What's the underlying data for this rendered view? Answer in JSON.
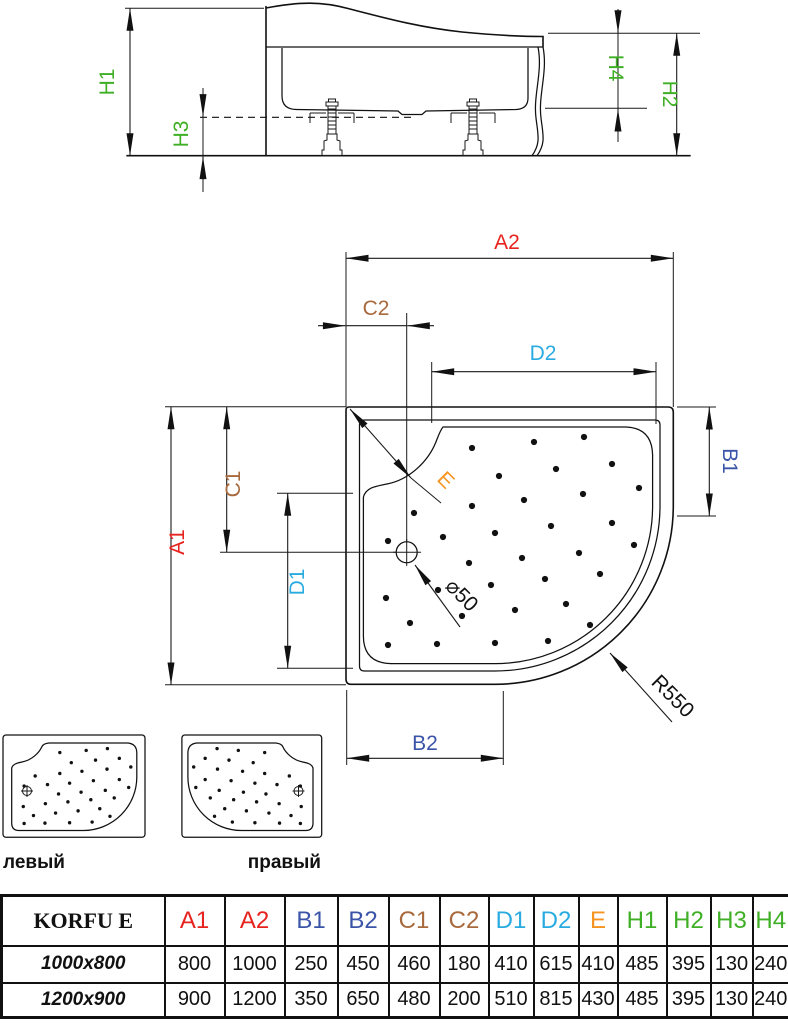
{
  "colors": {
    "red": "#e6231e",
    "blue": "#3a54a8",
    "brown": "#a86a3c",
    "cyan": "#29abe2",
    "orange": "#f79421",
    "green": "#3faf25",
    "line": "#111111"
  },
  "side_view": {
    "labels": {
      "h1": "H1",
      "h2": "H2",
      "h3": "H3",
      "h4": "H4"
    }
  },
  "top_view": {
    "labels": {
      "a1": "A1",
      "a2": "A2",
      "b1": "B1",
      "b2": "B2",
      "c1": "C1",
      "c2": "C2",
      "d1": "D1",
      "d2": "D2",
      "e": "E"
    },
    "drain_label": "⌀50",
    "radius_label": "R550",
    "dots": [
      [
        472,
        448
      ],
      [
        534,
        442
      ],
      [
        584,
        437
      ],
      [
        499,
        476
      ],
      [
        556,
        469
      ],
      [
        612,
        464
      ],
      [
        414,
        513
      ],
      [
        472,
        506
      ],
      [
        524,
        500
      ],
      [
        583,
        494
      ],
      [
        639,
        488
      ],
      [
        388,
        541
      ],
      [
        443,
        537
      ],
      [
        495,
        533
      ],
      [
        551,
        526
      ],
      [
        612,
        523
      ],
      [
        469,
        563
      ],
      [
        522,
        558
      ],
      [
        579,
        553
      ],
      [
        634,
        545
      ],
      [
        386,
        598
      ],
      [
        438,
        590
      ],
      [
        491,
        585
      ],
      [
        545,
        579
      ],
      [
        600,
        574
      ],
      [
        410,
        623
      ],
      [
        462,
        616
      ],
      [
        515,
        610
      ],
      [
        566,
        604
      ],
      [
        388,
        645
      ],
      [
        437,
        644
      ],
      [
        495,
        643
      ],
      [
        548,
        641
      ],
      [
        590,
        625
      ]
    ]
  },
  "variants": {
    "left_label": "левый",
    "right_label": "правый"
  },
  "table": {
    "title": "KORFU E",
    "columns": [
      {
        "label": "A1",
        "color": "red"
      },
      {
        "label": "A2",
        "color": "red"
      },
      {
        "label": "B1",
        "color": "blue"
      },
      {
        "label": "B2",
        "color": "blue"
      },
      {
        "label": "C1",
        "color": "brown"
      },
      {
        "label": "C2",
        "color": "brown"
      },
      {
        "label": "D1",
        "color": "cyan"
      },
      {
        "label": "D2",
        "color": "cyan"
      },
      {
        "label": "E",
        "color": "orange"
      },
      {
        "label": "H1",
        "color": "green"
      },
      {
        "label": "H2",
        "color": "green"
      },
      {
        "label": "H3",
        "color": "green"
      },
      {
        "label": "H4",
        "color": "green"
      }
    ],
    "rows": [
      {
        "size": "1000x800",
        "values": [
          800,
          1000,
          250,
          450,
          460,
          180,
          410,
          615,
          410,
          485,
          395,
          130,
          240
        ]
      },
      {
        "size": "1200x900",
        "values": [
          900,
          1200,
          350,
          650,
          480,
          200,
          510,
          815,
          430,
          485,
          395,
          130,
          240
        ]
      }
    ]
  }
}
